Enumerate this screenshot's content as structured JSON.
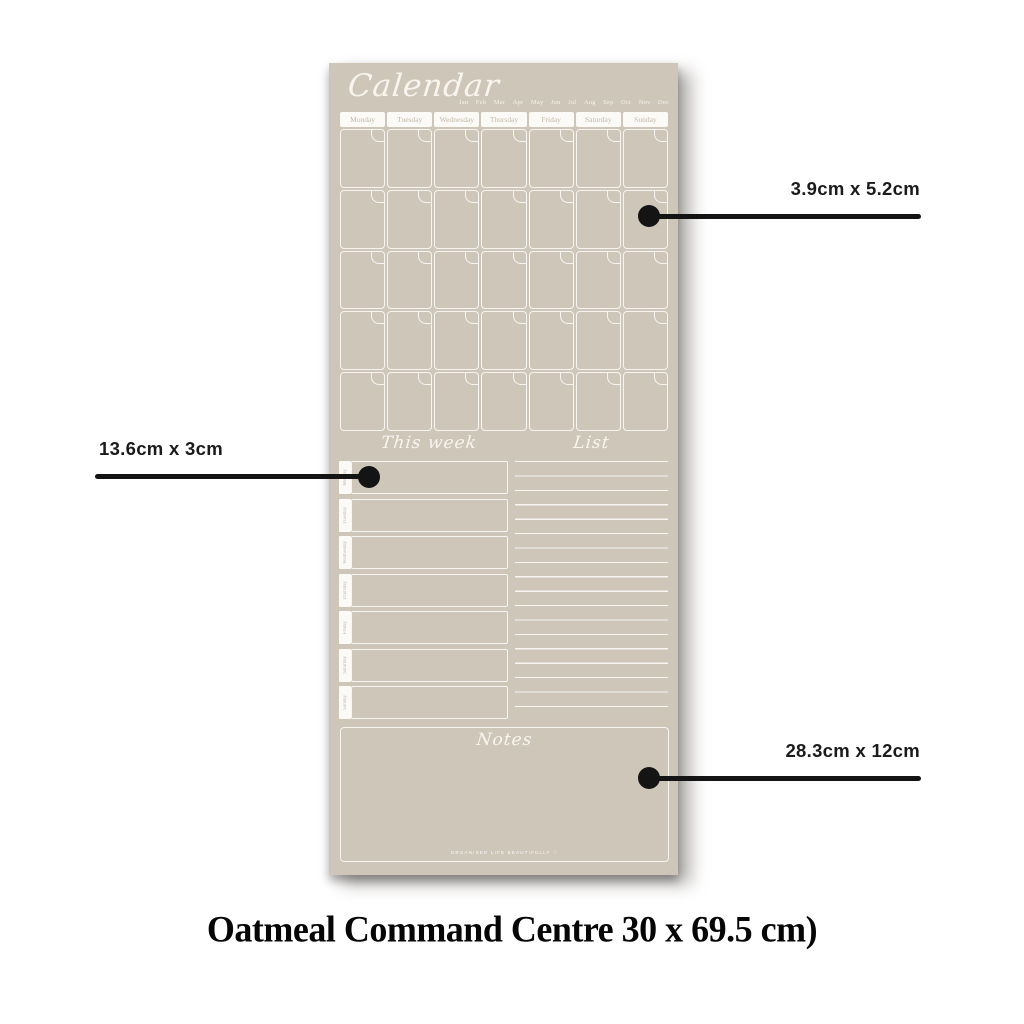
{
  "planner": {
    "title_script": "Calendar",
    "months": [
      "Jan",
      "Feb",
      "Mar",
      "Apr",
      "May",
      "Jun",
      "Jul",
      "Aug",
      "Sep",
      "Oct",
      "Nov",
      "Dec"
    ],
    "day_headers": [
      "Monday",
      "Tuesday",
      "Wednesday",
      "Thursday",
      "Friday",
      "Saturday",
      "Sunday"
    ],
    "calendar_rows": 5,
    "calendar_columns": 7,
    "week_section_title": "This week",
    "week_days": [
      "Monday",
      "Tuesday",
      "Wednesday",
      "Thursday",
      "Friday",
      "Saturday",
      "Sunday"
    ],
    "list_section_title": "List",
    "notes_title": "Notes",
    "branding": "ORGANISED LIFE BEAUTIFULLY ♡",
    "colors": {
      "board": "#cec6b9",
      "rule_lines": "#ffffff",
      "tab_text": "#c2b7a5",
      "callout_ink": "#141414"
    }
  },
  "callouts": [
    {
      "label": "3.9cm x 5.2cm",
      "points_to": "calendar-day-cell"
    },
    {
      "label": "13.6cm x 3cm",
      "points_to": "this-week-row"
    },
    {
      "label": "28.3cm x 12cm",
      "points_to": "notes-box"
    }
  ],
  "caption": "Oatmeal Command Centre 30 x 69.5 cm)"
}
